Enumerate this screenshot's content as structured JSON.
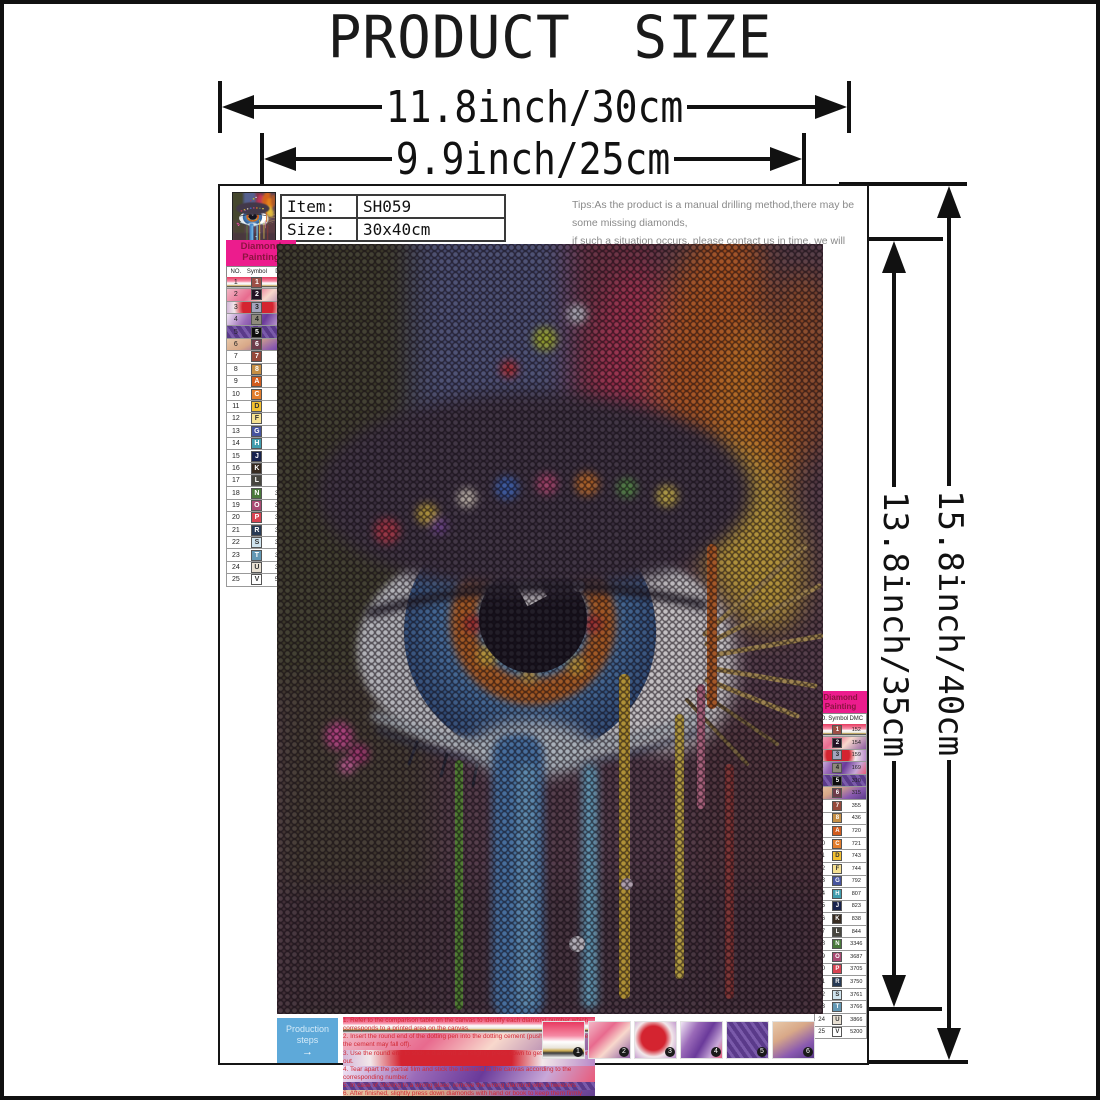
{
  "page": {
    "title": "PRODUCT SIZE"
  },
  "dimensions": {
    "outer_width": "11.8inch/30cm",
    "inner_width": "9.9inch/25cm",
    "outer_height": "15.8inch/40cm",
    "inner_height": "13.8inch/35cm"
  },
  "item_info": {
    "item_label": "Item:",
    "item_value": "SH059",
    "size_label": "Size:",
    "size_value": "30x40cm"
  },
  "tips": {
    "line1": "Tips:As the product is a manual drilling method,there may be some missing diamonds,",
    "line2": "if such a situation occurs, please contact us in time, we will reply to you within 24 hours,",
    "line3": "until you are satisfied."
  },
  "legend": {
    "title_line1": "Diamond",
    "title_line2": "Painting",
    "headers": [
      "NO.",
      "Symbol",
      "DMC"
    ],
    "header_bg": "#ec1c8d",
    "rows": [
      {
        "no": "1",
        "sym": "1",
        "dmc": "152",
        "bg": "#9c4f46",
        "fg": "#ffffff"
      },
      {
        "no": "2",
        "sym": "2",
        "dmc": "154",
        "bg": "#231325",
        "fg": "#ffffff"
      },
      {
        "no": "3",
        "sym": "3",
        "dmc": "159",
        "bg": "#a3a4bd",
        "fg": "#222222"
      },
      {
        "no": "4",
        "sym": "4",
        "dmc": "169",
        "bg": "#8f8a7c",
        "fg": "#222222"
      },
      {
        "no": "5",
        "sym": "5",
        "dmc": "310",
        "bg": "#0d0d0d",
        "fg": "#ffffff"
      },
      {
        "no": "6",
        "sym": "6",
        "dmc": "315",
        "bg": "#6e3c4b",
        "fg": "#ffffff"
      },
      {
        "no": "7",
        "sym": "7",
        "dmc": "355",
        "bg": "#96493b",
        "fg": "#ffffff"
      },
      {
        "no": "8",
        "sym": "8",
        "dmc": "436",
        "bg": "#c68f44",
        "fg": "#ffffff"
      },
      {
        "no": "9",
        "sym": "A",
        "dmc": "720",
        "bg": "#d25c1e",
        "fg": "#ffffff"
      },
      {
        "no": "10",
        "sym": "C",
        "dmc": "721",
        "bg": "#e37d2b",
        "fg": "#ffffff"
      },
      {
        "no": "11",
        "sym": "D",
        "dmc": "743",
        "bg": "#f3c02f",
        "fg": "#333333"
      },
      {
        "no": "12",
        "sym": "F",
        "dmc": "744",
        "bg": "#f6e191",
        "fg": "#333333"
      },
      {
        "no": "13",
        "sym": "G",
        "dmc": "792",
        "bg": "#47549f",
        "fg": "#ffffff"
      },
      {
        "no": "14",
        "sym": "H",
        "dmc": "807",
        "bg": "#409dae",
        "fg": "#ffffff"
      },
      {
        "no": "15",
        "sym": "J",
        "dmc": "823",
        "bg": "#17224d",
        "fg": "#ffffff"
      },
      {
        "no": "16",
        "sym": "K",
        "dmc": "838",
        "bg": "#372b20",
        "fg": "#ffffff"
      },
      {
        "no": "17",
        "sym": "L",
        "dmc": "844",
        "bg": "#47463f",
        "fg": "#ffffff"
      },
      {
        "no": "18",
        "sym": "N",
        "dmc": "3346",
        "bg": "#49793b",
        "fg": "#ffffff"
      },
      {
        "no": "19",
        "sym": "O",
        "dmc": "3687",
        "bg": "#aa4a73",
        "fg": "#ffffff"
      },
      {
        "no": "20",
        "sym": "P",
        "dmc": "3705",
        "bg": "#d84352",
        "fg": "#ffffff"
      },
      {
        "no": "21",
        "sym": "R",
        "dmc": "3750",
        "bg": "#273a55",
        "fg": "#ffffff"
      },
      {
        "no": "22",
        "sym": "S",
        "dmc": "3761",
        "bg": "#cfe4ef",
        "fg": "#333333"
      },
      {
        "no": "23",
        "sym": "T",
        "dmc": "3766",
        "bg": "#6398b4",
        "fg": "#ffffff"
      },
      {
        "no": "24",
        "sym": "U",
        "dmc": "3866",
        "bg": "#e9e1d3",
        "fg": "#333333"
      },
      {
        "no": "25",
        "sym": "V",
        "dmc": "5200",
        "bg": "#ffffff",
        "fg": "#333333"
      }
    ]
  },
  "production": {
    "line1": "Production",
    "line2": "steps",
    "arrow": "→",
    "box_color": "#5ea9d9"
  },
  "instructions": [
    "1. Refer to the comparison table on the canvas to identify each diamond number which corresponds to a printed area on the canvas.",
    "2. Insert the round end of the dotting pen into the dotting cement (push hard, otherwise the cement may fall off).",
    "3. Use the round end to stick a diamond and slightly press down to get the extra cement out.",
    "4. Tear apart the partial film and stick the diamond to the canvas according to the corresponding number.",
    "5. In case of sticking to a wrong place, remove the wrong diamond with a tweezers.",
    "6. After finished, slightly press down diamonds with hand or book to keep them firmly attached."
  ],
  "steps": {
    "badges": [
      "1",
      "2",
      "3",
      "4",
      "5",
      "6"
    ]
  }
}
